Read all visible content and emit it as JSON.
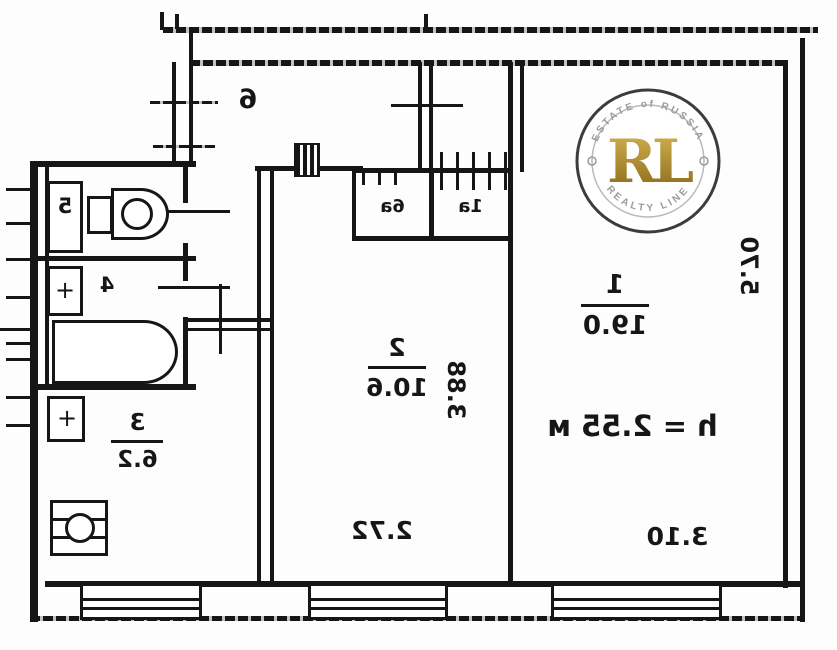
{
  "watermark": {
    "monogram": "RL",
    "arc_top": "ESTATE of RUSSIA",
    "arc_bottom": "REALTY LINE",
    "gold": "#b08d2e",
    "ring_color": "#3c3c3c",
    "arc_text_color": "#9b9b9b"
  },
  "plan": {
    "ink": "#161616",
    "height_note": "h = 2.55 м",
    "vent_mark": "+",
    "rooms": {
      "room1": {
        "number": "1",
        "area": "19.0"
      },
      "room2": {
        "number": "2",
        "area": "10.6"
      },
      "kitchen": {
        "number": "3",
        "area": "6.2"
      },
      "bathroom": {
        "number": "4"
      },
      "toilet": {
        "number": "5"
      },
      "hallway": {
        "number": "6"
      },
      "closet_6a": {
        "number": "6а"
      },
      "closet_1a": {
        "number": "1а"
      }
    },
    "dimensions": {
      "room2_width": "2.72",
      "room1_width": "3.10",
      "room2_depth": "3.88",
      "room1_depth": "5.70"
    }
  }
}
